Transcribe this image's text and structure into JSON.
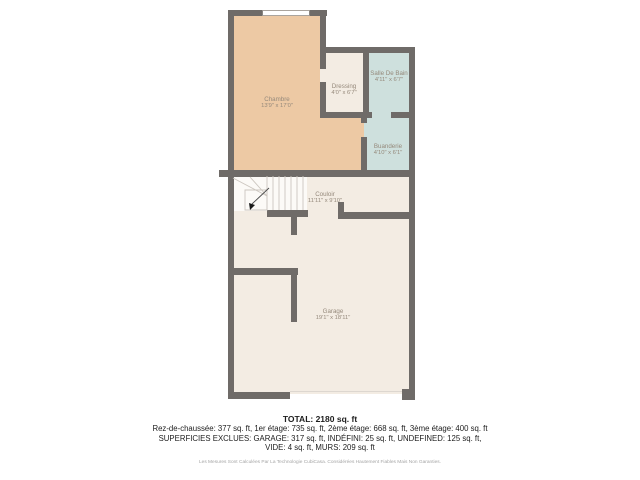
{
  "plan": {
    "title": "floor-plan",
    "rooms": [
      {
        "id": "chambre",
        "name": "Chambre",
        "dims": "13'9\" x 17'0\""
      },
      {
        "id": "dressing",
        "name": "Dressing",
        "dims": "4'0\" x 6'7\""
      },
      {
        "id": "salle_de_bain",
        "name": "Salle De Bain",
        "dims": "4'11\" x 6'7\""
      },
      {
        "id": "buanderie",
        "name": "Buanderie",
        "dims": "4'10\" x 6'1\""
      },
      {
        "id": "couloir",
        "name": "Couloir",
        "dims": "11'11\" x 9'10\""
      },
      {
        "id": "garage",
        "name": "Garage",
        "dims": "19'1\" x 18'11\""
      }
    ],
    "icons": [
      "stairs-icon",
      "window-icon"
    ]
  },
  "summary": {
    "total": "TOTAL: 2180 sq. ft",
    "line1": "Rez-de-chaussée: 377 sq. ft, 1er étage: 735 sq. ft, 2ème étage: 668 sq. ft, 3ème étage: 400 sq. ft",
    "line2": "SUPERFICIES EXCLUES: GARAGE: 317 sq. ft, INDÉFINI: 25 sq. ft, UNDEFINED: 125 sq. ft,",
    "line3": "VIDE: 4 sq. ft, MURS: 209 sq. ft",
    "disclaimer": "Les Mesures Sont Calculées Par La Technologie CubiCasa. Considérées Hautement Fiables Mais Non Garanties."
  },
  "colors": {
    "wall": "#6f6b68",
    "bedroom": "#edc9a4",
    "floor": "#f3ece3",
    "wet": "#cee0dd",
    "stairs": "#fcfaf7",
    "label": "#95897b",
    "textc": "#1d1d1d",
    "muted": "#a5a5a5"
  }
}
